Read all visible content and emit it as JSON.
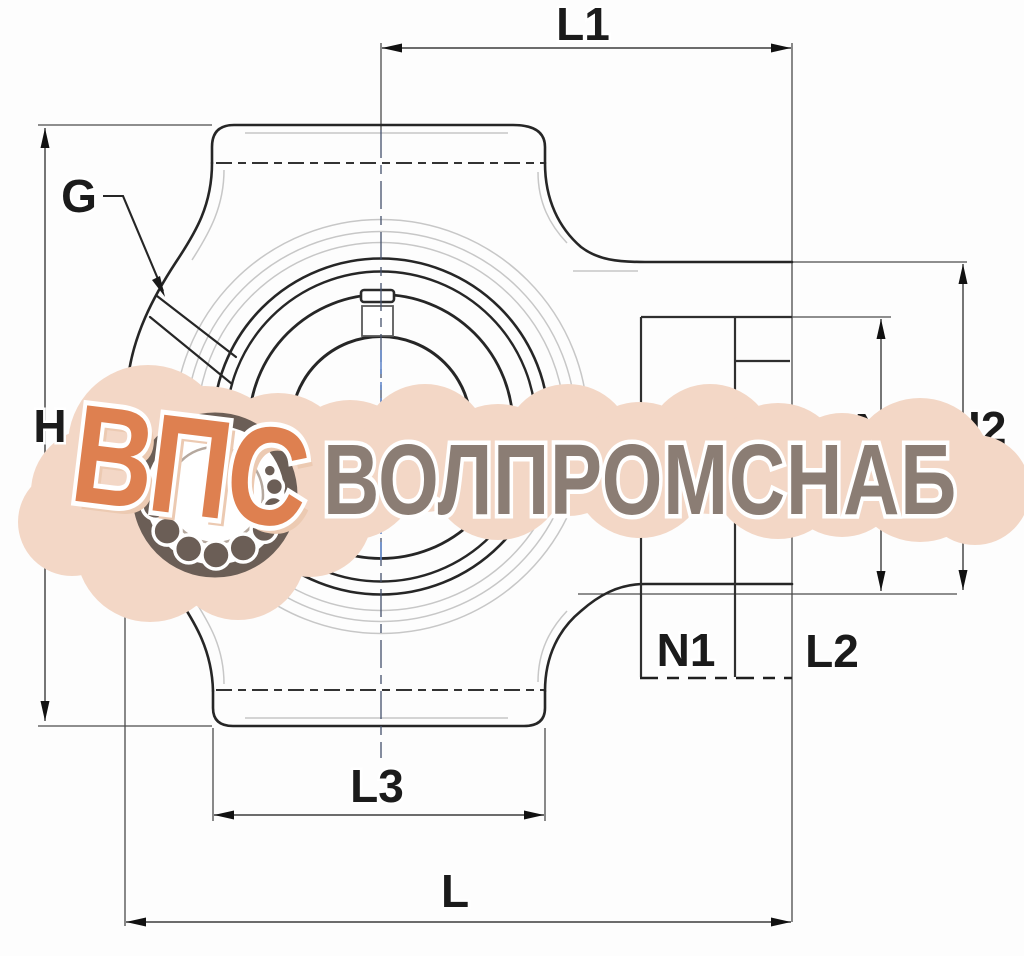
{
  "drawing": {
    "labels": {
      "l1": "L1",
      "g": "G",
      "h": "H",
      "n2": "N2",
      "h2": "H2",
      "n1": "N1",
      "l2": "L2",
      "l3": "L3",
      "l": "L"
    }
  },
  "watermark": {
    "logo_text": "ВПС",
    "company_text": "ВОЛПРОМСНАБ",
    "colors": {
      "cloud": "#f3d7c6",
      "logo_orange": "#de8050",
      "logo_shadow": "#eccab2",
      "company_gray": "#8b7d74",
      "bearing_dark": "#6b5e56"
    }
  }
}
